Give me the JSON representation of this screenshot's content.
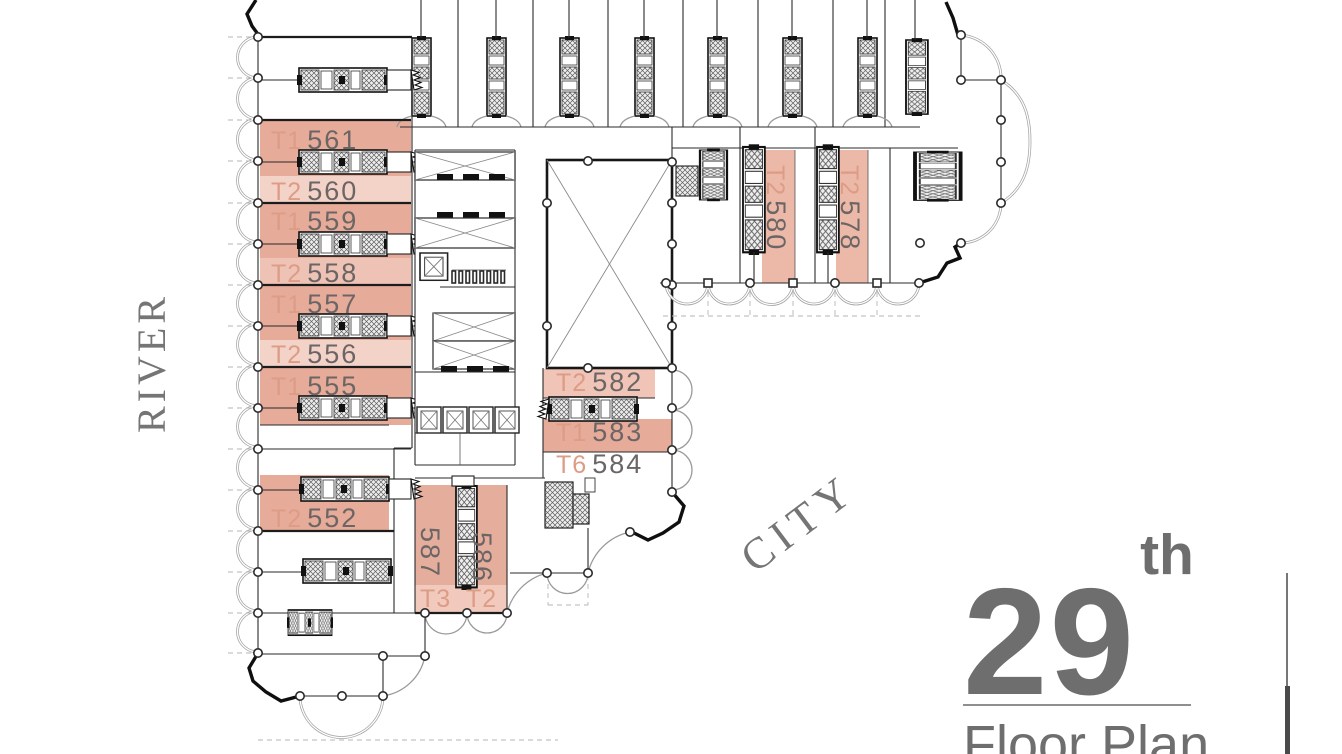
{
  "context_labels": {
    "river": "RIVER",
    "city": "CITY"
  },
  "title_block": {
    "floor_number": "29",
    "ordinal_suffix": "th",
    "caption": "Floor Plan"
  },
  "units": {
    "left_column": [
      {
        "type": "T1",
        "number": "561"
      },
      {
        "type": "T2",
        "number": "560"
      },
      {
        "type": "T1",
        "number": "559"
      },
      {
        "type": "T2",
        "number": "558"
      },
      {
        "type": "T1",
        "number": "557"
      },
      {
        "type": "T2",
        "number": "556"
      },
      {
        "type": "T1",
        "number": "555"
      },
      {
        "type": "T2",
        "number": "552"
      }
    ],
    "right_wing": [
      {
        "type": "T2",
        "number": "580"
      },
      {
        "type": "T2",
        "number": "578"
      }
    ],
    "center": [
      {
        "type": "T2",
        "number": "582"
      },
      {
        "type": "T1",
        "number": "583"
      },
      {
        "type": "T6",
        "number": "584"
      }
    ],
    "bottom": [
      {
        "type": "T3",
        "number": "587"
      },
      {
        "type": "T2",
        "number": "586"
      }
    ]
  },
  "legend_colors": {
    "unit_dark": "#e7ab99",
    "unit_light": "#f3d2c8",
    "unit_medium": "#eec3b5",
    "type_label": "#dd9c85",
    "number_label": "#6b6565",
    "title_text": "#6e6e6e",
    "context_text": "#757575",
    "wall": "#2a2a2a"
  }
}
